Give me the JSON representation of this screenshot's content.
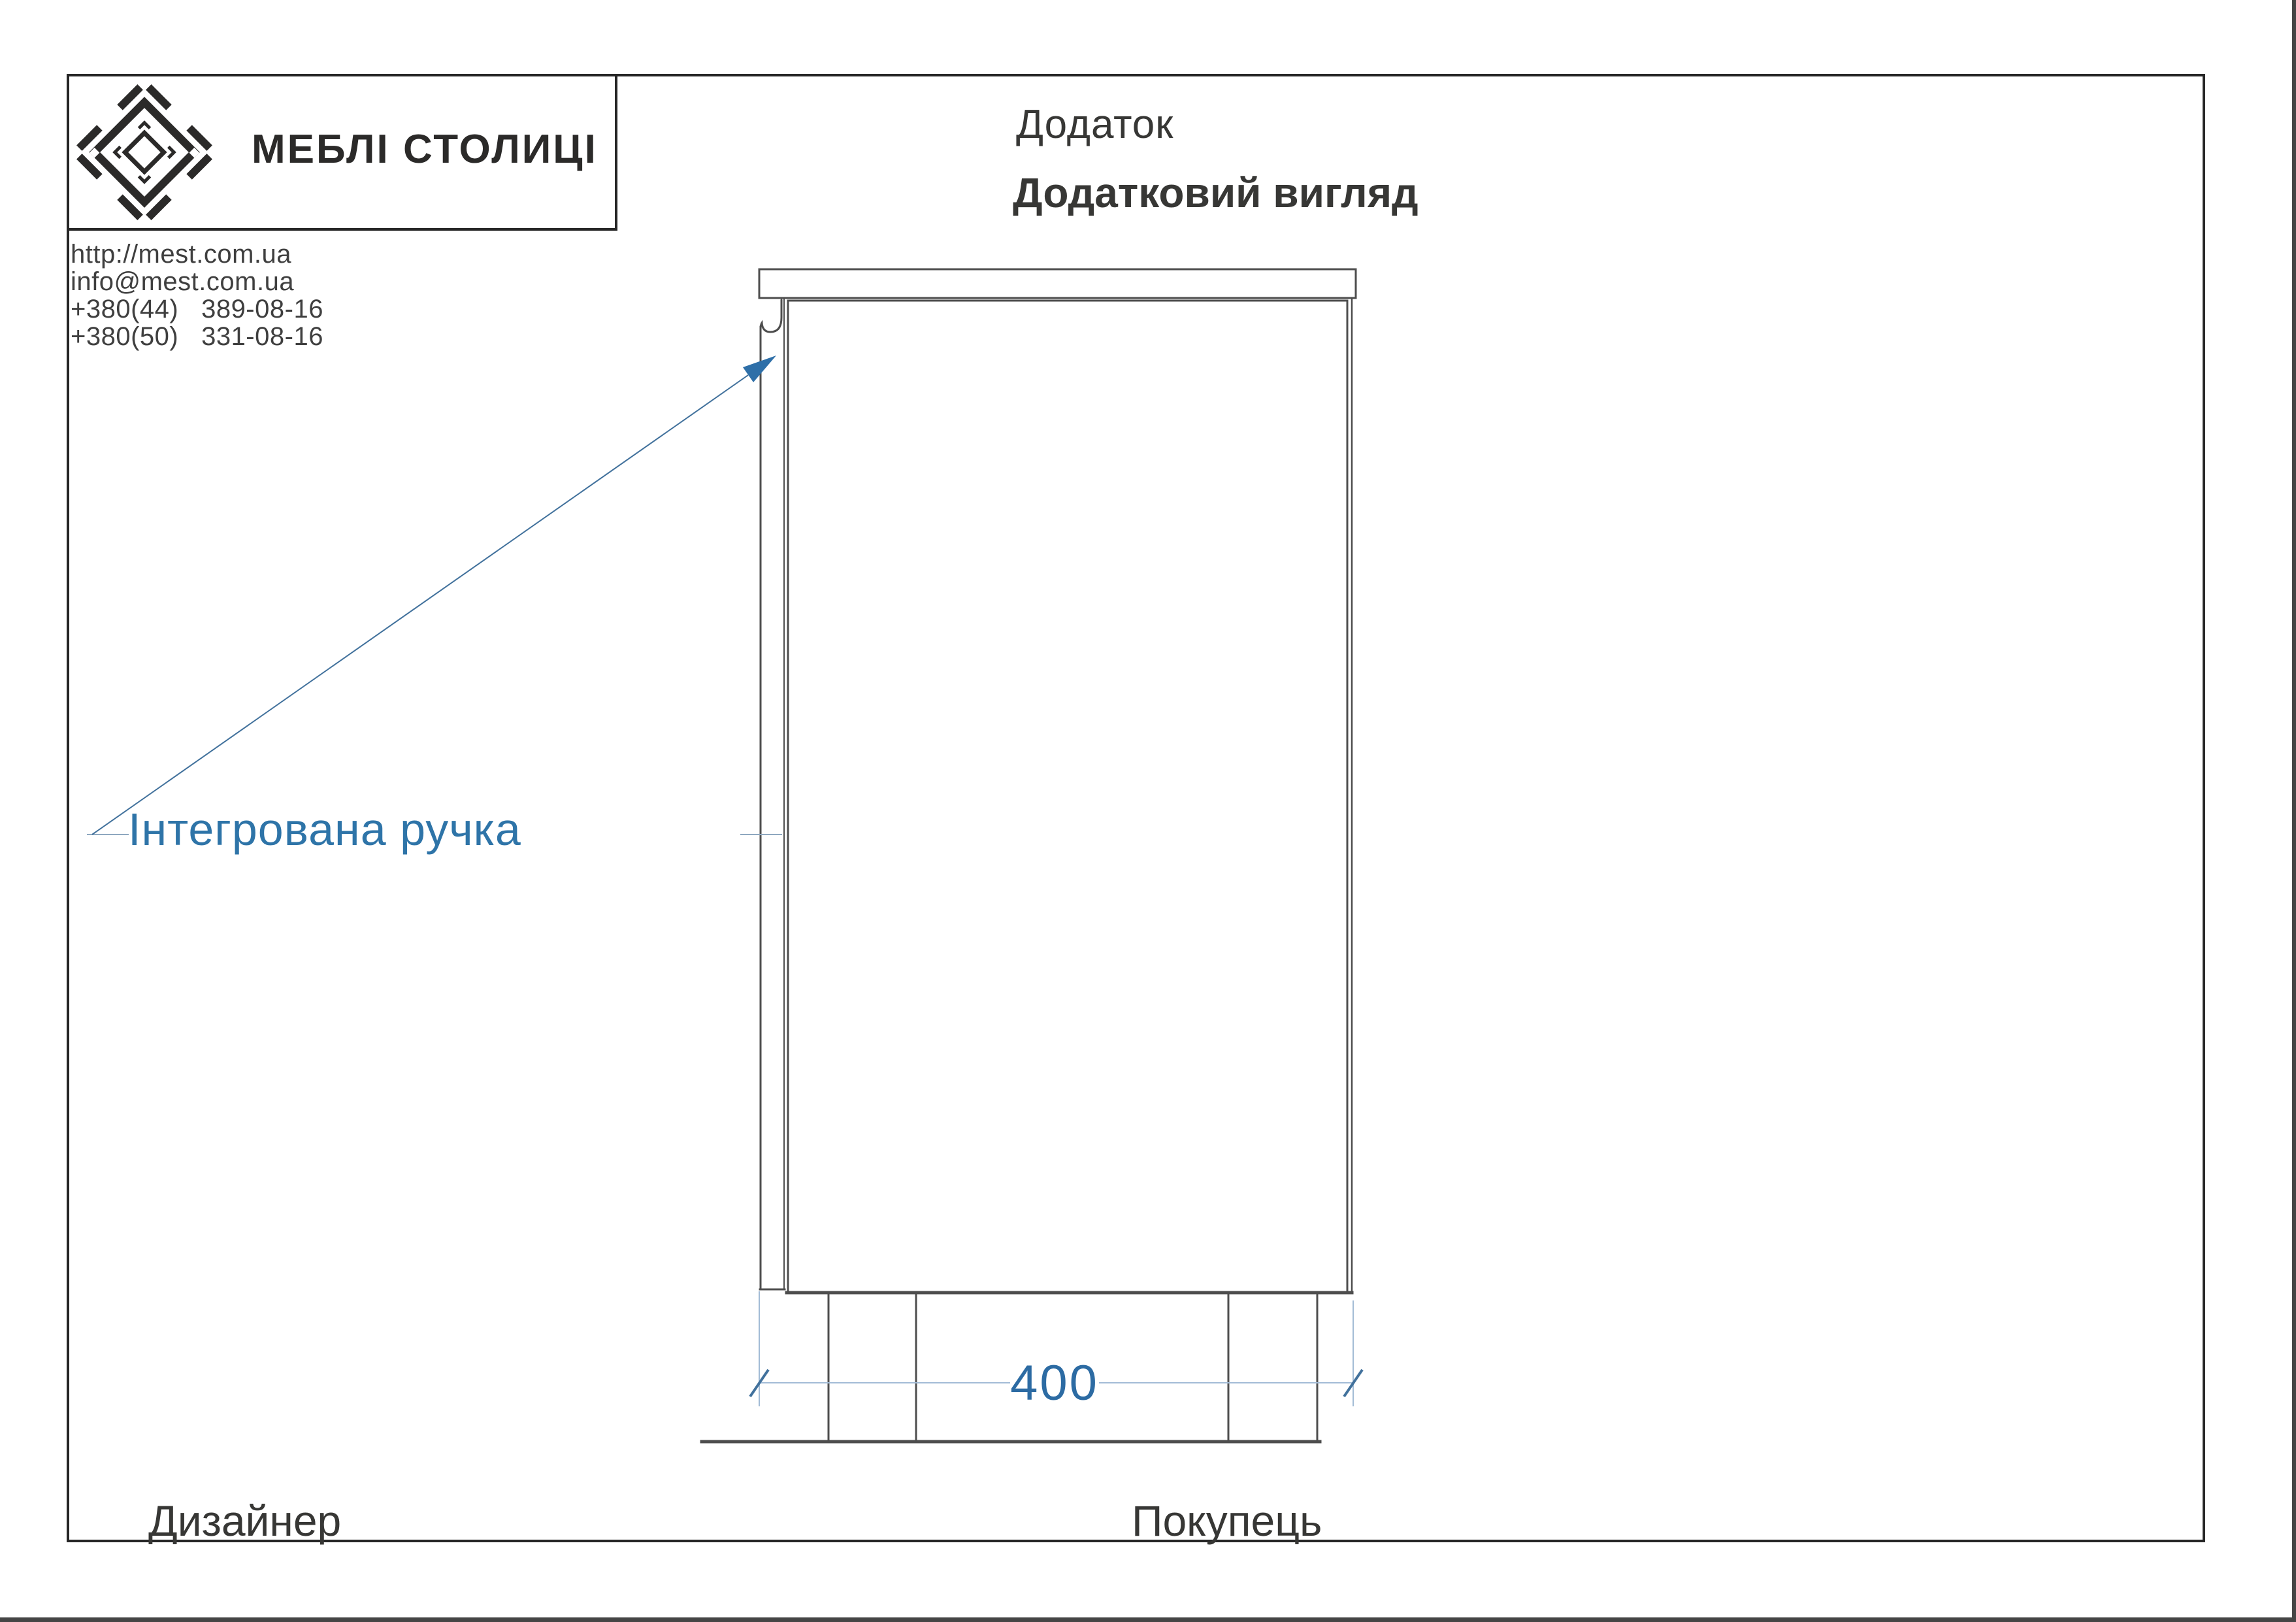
{
  "header": {
    "logo": {
      "brand_text": "МЕБЛІ СТОЛИЦІ"
    },
    "contact": {
      "website": "http://mest.com.ua",
      "email": "info@mest.com.ua",
      "phone1": "+380(44)   389-08-16",
      "phone2": "+380(50)   331-08-16"
    },
    "title": "Додаток",
    "subtitle": "Додатковий вигляд"
  },
  "drawing": {
    "annotation": "Інтегрована ручка",
    "dimension_width": "400"
  },
  "footer": {
    "designer_label": "Дизайнер",
    "buyer_label": "Покупець"
  },
  "colors": {
    "frame_border": "#262626",
    "logo_ink": "#2b2a29",
    "drawing_line_gray": "#4d4d4d",
    "annotation_blue": "#2e74a8",
    "dimension_text_blue": "#2c6ba3",
    "dimension_line_blue": "#a3bcd6",
    "dimension_tick_blue": "#41719c",
    "arrow_fill_blue": "#2e6fa8",
    "window_edge_gray": "#454545"
  }
}
